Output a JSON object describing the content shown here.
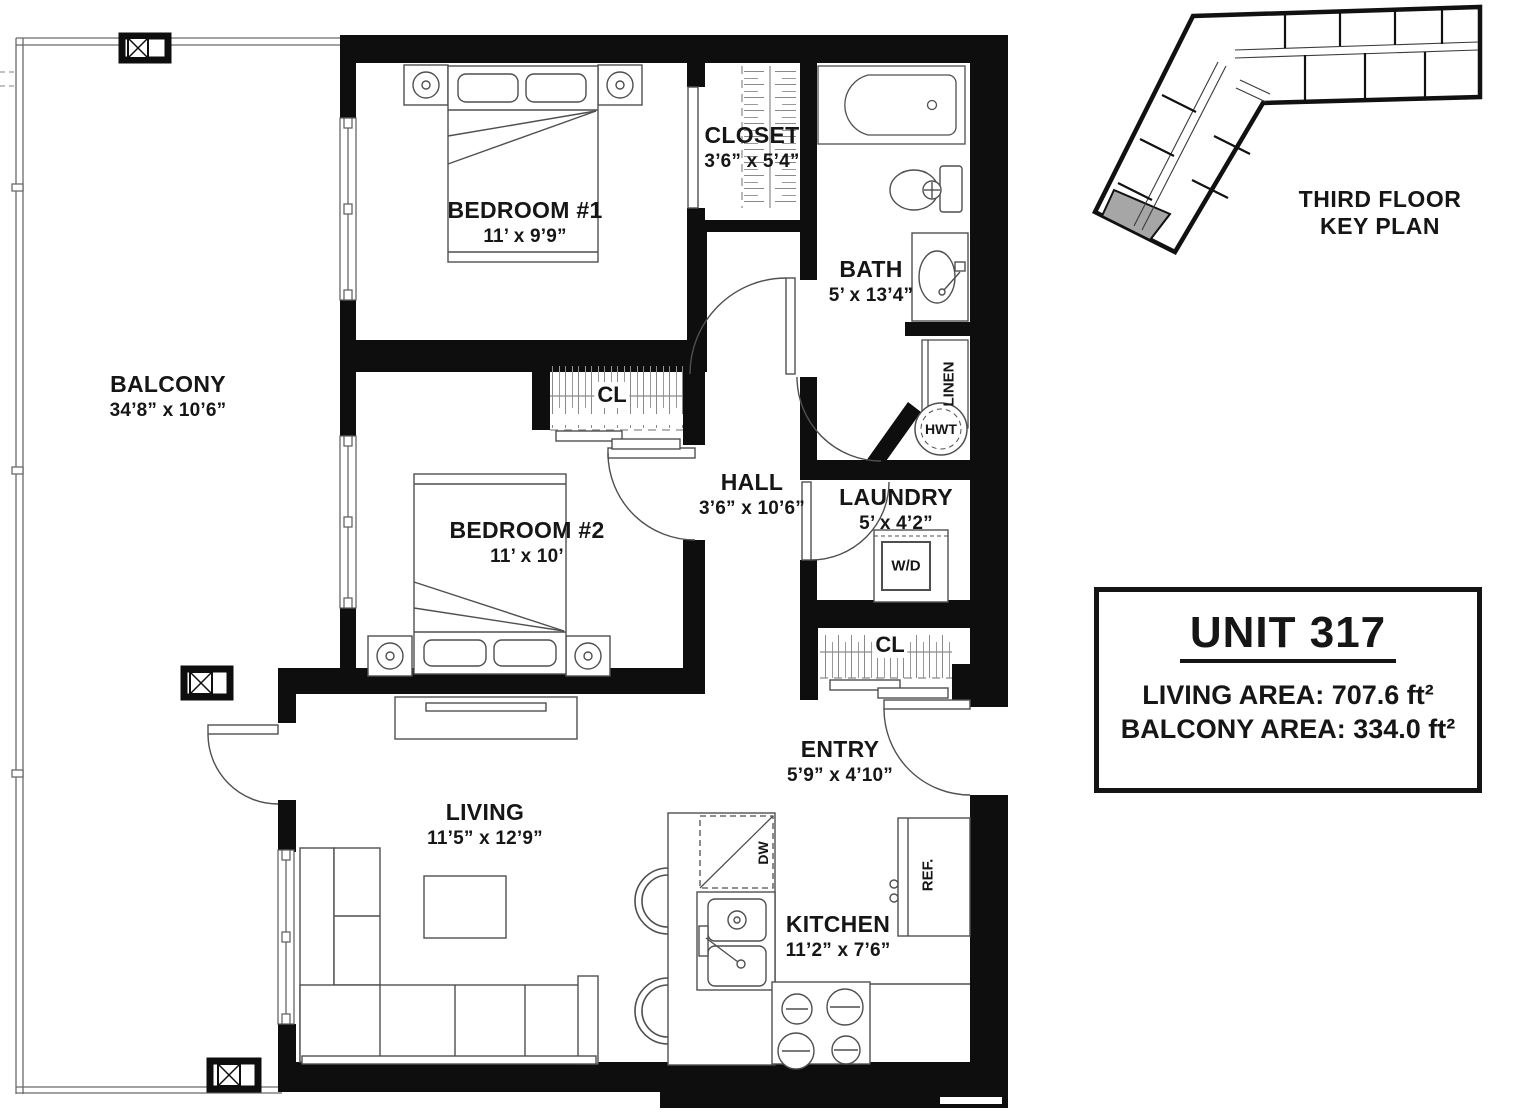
{
  "plan": {
    "rooms": {
      "balcony": {
        "name": "BALCONY",
        "dims": "34’8” x 10’6”"
      },
      "bedroom1": {
        "name": "BEDROOM #1",
        "dims": "11’ x 9’9”"
      },
      "closet": {
        "name": "CLOSET",
        "dims": "3’6” x 5’4”"
      },
      "bath": {
        "name": "BATH",
        "dims": "5’ x 13’4”"
      },
      "hall": {
        "name": "HALL",
        "dims": "3’6” x 10’6”"
      },
      "laundry": {
        "name": "LAUNDRY",
        "dims": "5’ x 4’2”"
      },
      "bedroom2": {
        "name": "BEDROOM #2",
        "dims": "11’ x 10’"
      },
      "entry": {
        "name": "ENTRY",
        "dims": "5’9” x 4’10”"
      },
      "living": {
        "name": "LIVING",
        "dims": "11’5” x 12’9”"
      },
      "kitchen": {
        "name": "KITCHEN",
        "dims": "11’2” x 7’6”"
      }
    },
    "fixtures": {
      "cl": "CL",
      "linen": "LINEN",
      "hwt": "HWT",
      "washer_dryer": "W/D",
      "dishwasher": "DW",
      "refrigerator": "REF."
    }
  },
  "key_plan": {
    "line1": "THIRD FLOOR",
    "line2": "KEY PLAN"
  },
  "unit_info": {
    "title": "UNIT 317",
    "living_area": "LIVING AREA: 707.6 ft²",
    "balcony_area": "BALCONY AREA: 334.0 ft²"
  },
  "colors": {
    "wall": "#0e0e0e",
    "furniture_line": "#4f4f4f",
    "railing": "#6a6a6a",
    "keyplan_highlight": "#a6a6a6",
    "text": "#161616"
  }
}
